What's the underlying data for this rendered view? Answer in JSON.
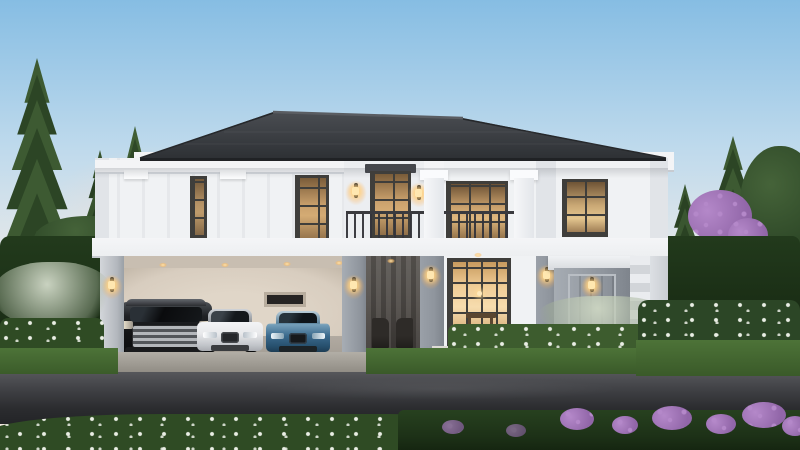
{
  "scene": {
    "type": "architectural-exterior-render",
    "description": "Luxury two-storey detached house at dusk with a wide carport holding three cars, warm interior lighting, manicured garden and an asphalt road in the foreground",
    "time_of_day": "dusk",
    "sky": "clear pale blue fading to soft pink at the horizon"
  },
  "house": {
    "storeys": 2,
    "roof": "low-pitch hipped roof, dark charcoal tiles, white fascia and cornice",
    "facade": "white walls with pale grey trim, grey pilasters and classical mouldings",
    "balcony": "central balcony with dark metal railing between white columns",
    "upper_windows": 5,
    "upper_windows_state": "dark frames, warm light glowing inside",
    "entrance": "double-height glazed entrance door, brightly lit, dining table silhouette visible inside",
    "secondary_door": "grey panelled side door with white pediment and stone quoins",
    "carport": "open carport under the left wing with beige rear wall, small window and warm ceiling downlights",
    "wall_lanterns": 7,
    "ceiling_downlights": 5
  },
  "vehicles": [
    {
      "type": "luxury MPV van",
      "color": "black",
      "position": "left carport bay",
      "facing": "viewer"
    },
    {
      "type": "sedan",
      "color": "white",
      "position": "middle carport bay",
      "facing": "viewer"
    },
    {
      "type": "sedan",
      "color": "blue",
      "position": "right carport bay",
      "facing": "viewer"
    }
  ],
  "landscape": {
    "left": "three tall pine trees, clipped hedge, silvery plume grasses and white flower bed",
    "right": "two pine trees, broadleaf trees, purple blossom tree, trimmed hedge, white flowering shrubs",
    "right_garden_furniture": "white outdoor lounge sofa on stone patio with low table, lit candle lamp and bollard path lights",
    "foreground": "dark asphalt road with light concrete curb; grass verge with tiny white flowers on the left, hedge with purple-pink flowers on the right"
  },
  "palette": {
    "sky_top": "#86bde3",
    "sky_mid": "#bdd9ec",
    "sky_low": "#e2e7ea",
    "sky_horizon": "#f2e7e0",
    "roof_hi": "#4a4d52",
    "roof_lo": "#2e3135",
    "fascia": "#f3f4f6",
    "wall_white": "#f0f2f4",
    "wall_shade": "#e1e4e8",
    "wall_panel": "#eceef1",
    "trim_gray": "#c7cbd1",
    "pilaster_gray": "#8f959d",
    "pilaster_dark": "#7c828a",
    "band": "#edeff1",
    "carport_wall": "#d8cdbf",
    "carport_ceiling": "#c8beb1",
    "carport_floor": "#a39d94",
    "frame_dark": "#3f3e3b",
    "glass_warm_hi": "#c9a06c",
    "glass_warm_lo": "#7a5c39",
    "glass_bright": "#f0cd97",
    "porch_dark": "#54504c",
    "railing": "#3a3a3e",
    "concrete": "#b2aea6",
    "concrete_dark": "#8e8a82",
    "asphalt_hi": "#56575b",
    "asphalt_lo": "#232427",
    "grass": "#4d7338",
    "grass_dark": "#2f4b24",
    "hedge": "#223a1c",
    "hedge_fore": "#1d3117",
    "foliage": "#456339",
    "foliage_dark": "#2c4626",
    "pine": "#3d5a32",
    "pine_d": "#2c4525",
    "purple": "#9166a8",
    "purple_hi": "#b488c9",
    "flower_white": "#eaeee5",
    "lamp": "#ffd9a1",
    "car_black": "#141517",
    "car_white": "#e8e9eb",
    "car_blue": "#3a698c",
    "sofa": "#e7e3d9"
  }
}
